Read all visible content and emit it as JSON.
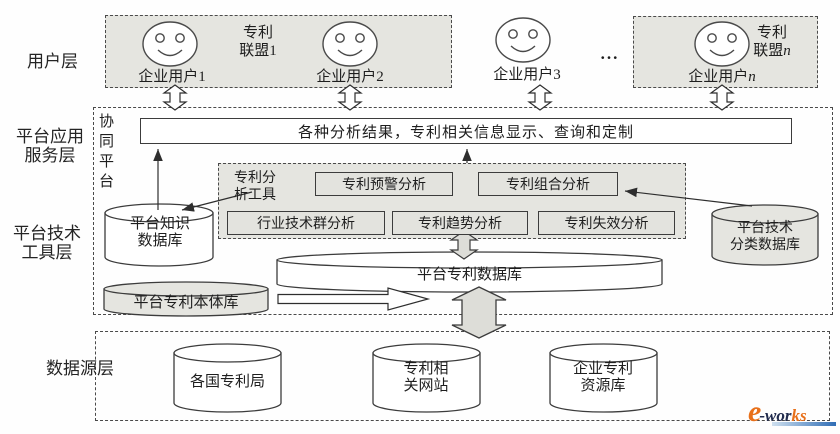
{
  "colors": {
    "shade": "#e5e5e0",
    "border": "#3c3c3c",
    "logo_orange": "#e8701a",
    "logo_navy": "#222c4e",
    "logo_bar_blue": "#2f6db5"
  },
  "layers": {
    "user": "用户层",
    "app": "平台应用\n服务层",
    "tech": "平台技术\n工具层",
    "source": "数据源层"
  },
  "user_layer": {
    "alliance1": {
      "line1": "专利",
      "line2": "联盟1"
    },
    "alliance_n": {
      "line1": "专利",
      "line2_prefix": "联盟",
      "suffix": "n"
    },
    "users": {
      "u1": {
        "label": "企业用户1"
      },
      "u2": {
        "label": "企业用户2"
      },
      "u3": {
        "label": "企业用户3"
      },
      "un": {
        "prefix": "企业用户",
        "suffix": "n"
      }
    },
    "ellipsis": "..."
  },
  "app_layer": {
    "collab_platform": "协同平台",
    "results_bar": "各种分析结果，专利相关信息显示、查询和定制"
  },
  "tools": {
    "label": "专利分\n析工具",
    "row1": [
      "专利预警分析",
      "专利组合分析"
    ],
    "row2": [
      "行业技术群分析",
      "专利趋势分析",
      "专利失效分析"
    ]
  },
  "databases": {
    "knowledge": "平台知识\n数据库",
    "tech_class": "平台技术\n分类数据库",
    "patent": "平台专利数据库",
    "ontology": "平台专利本体库"
  },
  "sources": {
    "s1": "各国专利局",
    "s2": "专利相\n关网站",
    "s3": "企业专利\n资源库"
  },
  "watermark": {
    "part1": "e",
    "part2": "-wor",
    "part3": "ks"
  }
}
